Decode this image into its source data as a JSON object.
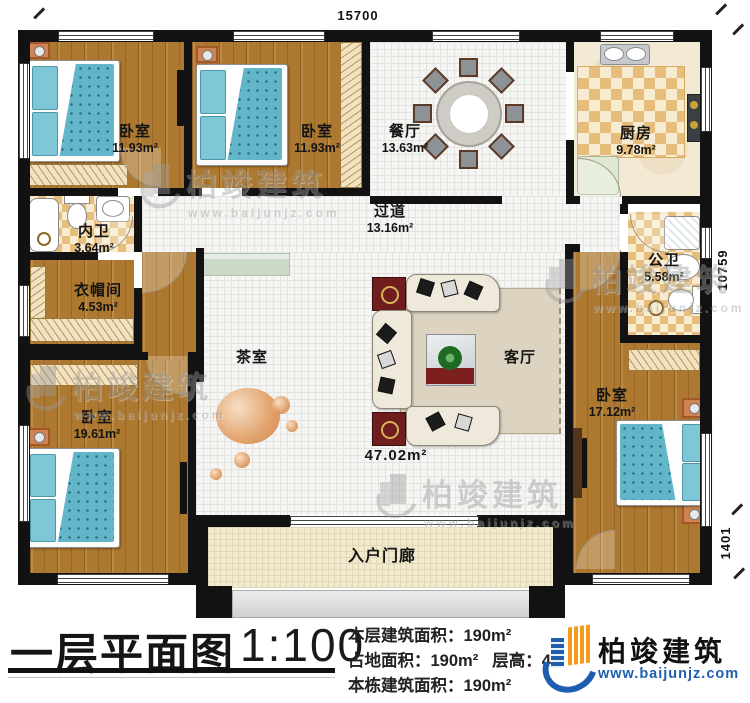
{
  "plan": {
    "dimensions": {
      "top": "15700",
      "right": "10759",
      "right_lower": "1401"
    },
    "rooms": {
      "bedroom_top_left": {
        "label": "卧室",
        "area": "11.93m²"
      },
      "bedroom_top_mid": {
        "label": "卧室",
        "area": "11.93m²"
      },
      "dining": {
        "label": "餐厅",
        "area": "13.63m²"
      },
      "kitchen": {
        "label": "厨房",
        "area": "9.78m²"
      },
      "inner_bath": {
        "label": "内卫",
        "area": "3.64m²"
      },
      "hallway": {
        "label": "过道",
        "area": "13.16m²"
      },
      "cloakroom": {
        "label": "衣帽间",
        "area": "4.53m²"
      },
      "public_bath": {
        "label": "公卫",
        "area": "5.58m²"
      },
      "tea_room": {
        "label": "茶室"
      },
      "living_room": {
        "label": "客厅",
        "area": "47.02m²"
      },
      "bedroom_bottom_left": {
        "label": "卧室",
        "area": "19.61m²"
      },
      "bedroom_right": {
        "label": "卧室",
        "area": "17.12m²"
      },
      "porch": {
        "label": "入户门廊"
      }
    }
  },
  "footer": {
    "title": "一层平面图",
    "scale": "1:100",
    "stats": {
      "line1_label": "本层建筑面积：",
      "line1_value": "190m²",
      "line2a_label": "占地面积：",
      "line2a_value": "190m²",
      "line2b_label": "层高：",
      "line2b_value": "4",
      "line3_label": "本栋建筑面积：",
      "line3_value": "190m²"
    },
    "brand": {
      "name": "柏竣建筑",
      "url": "www.baijunjz.com"
    }
  },
  "watermark": {
    "name": "柏竣建筑",
    "url": "www.baijunjz.com"
  },
  "colors": {
    "wall": "#121212",
    "wood_floor": "#ad7830",
    "tile_checker": "#e6bd7b",
    "bed_teal": "#63b6ca",
    "nightstand_orange": "#d08353",
    "brand_blue": "#1d5fae",
    "brand_orange": "#f59c1e",
    "rug_beige": "#dcd3c0"
  }
}
